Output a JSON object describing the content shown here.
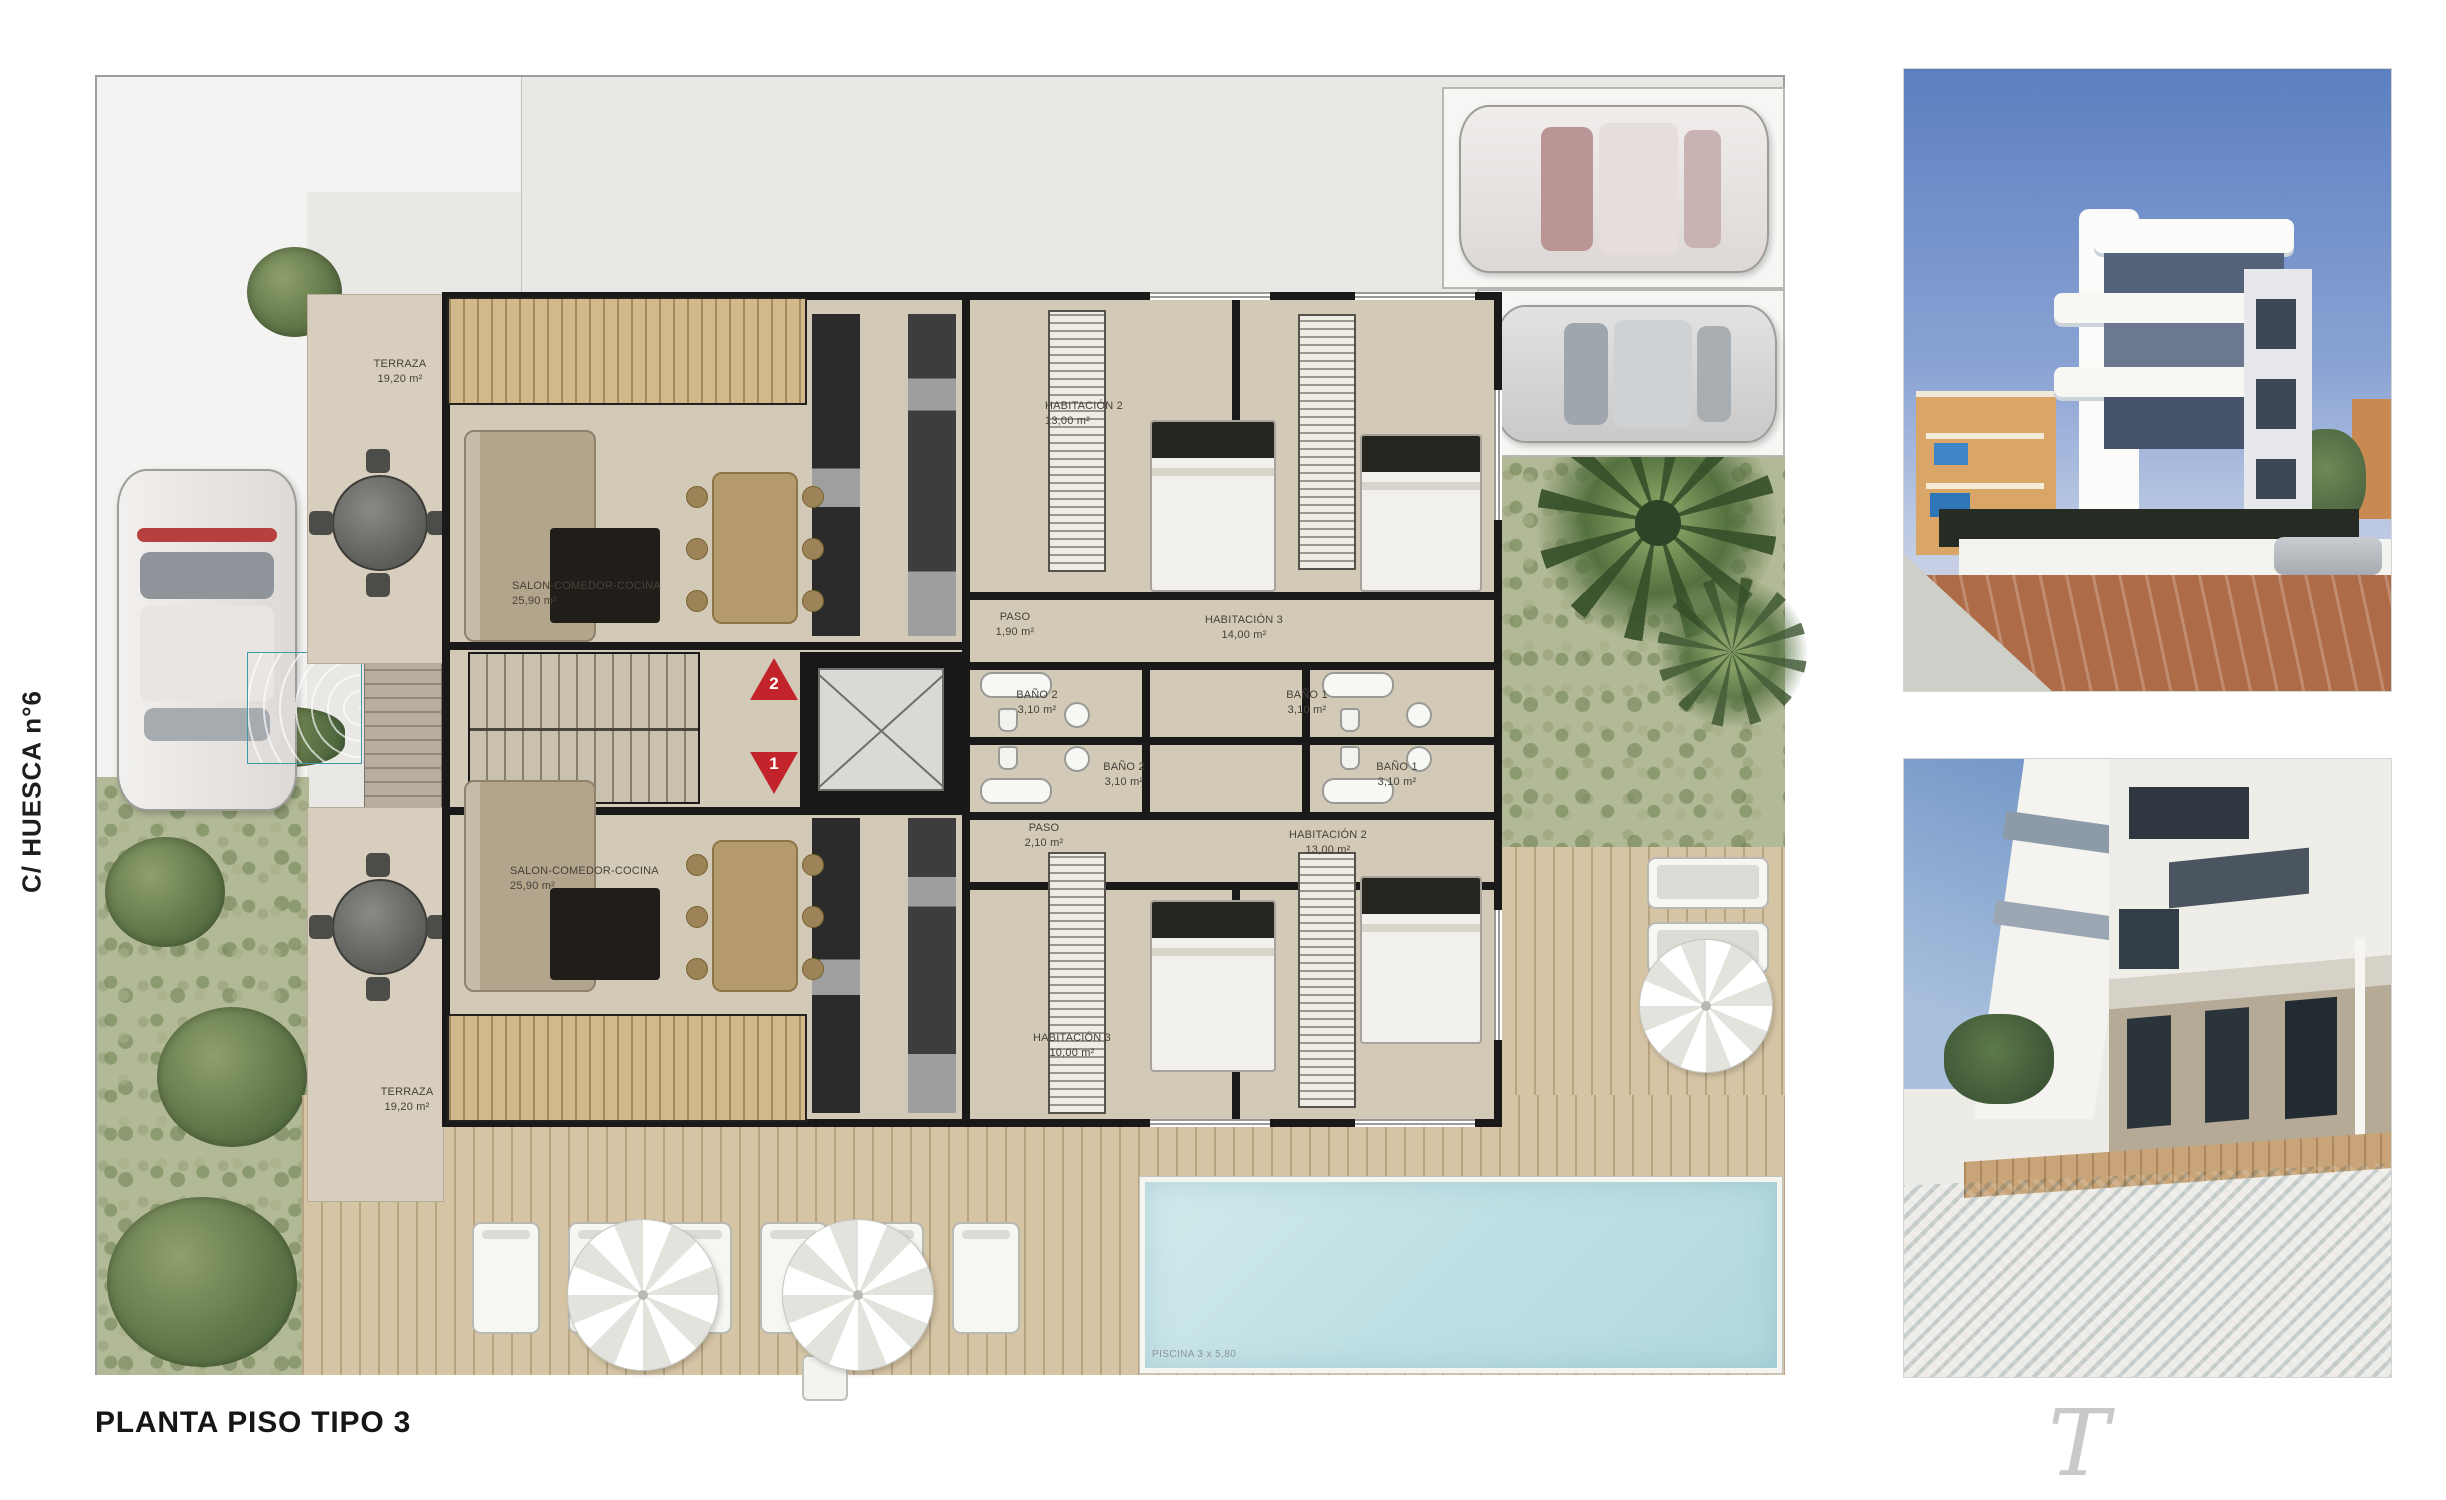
{
  "page": {
    "title": "PLANTA PISO TIPO 3",
    "street_label": "C/ HUESCA n°6",
    "signature": "T"
  },
  "plan": {
    "pool_label": "PISCINA 3 x 5,80",
    "markers": [
      {
        "number": "2"
      },
      {
        "number": "1"
      }
    ],
    "labels": [
      {
        "name": "TERRAZA",
        "area": "19,20 m²"
      },
      {
        "name": "SALON-COMEDOR-COCINA",
        "area": "25,90 m²"
      },
      {
        "name": "HABITACIÓN 2",
        "area": "13,00 m²"
      },
      {
        "name": "PASO",
        "area": "1,90 m²"
      },
      {
        "name": "HABITACIÓN 3",
        "area": "14,00 m²"
      },
      {
        "name": "BAÑO 2",
        "area": "3,10 m²"
      },
      {
        "name": "BAÑO 1",
        "area": "3,10 m²"
      },
      {
        "name": "SALON-COMEDOR-COCINA",
        "area": "25,90 m²"
      },
      {
        "name": "TERRAZA",
        "area": "19,20 m²"
      },
      {
        "name": "PASO",
        "area": "2,10 m²"
      },
      {
        "name": "HABITACIÓN 2",
        "area": "13,00 m²"
      },
      {
        "name": "BAÑO 2",
        "area": "3,10 m²"
      },
      {
        "name": "BAÑO 1",
        "area": "3,10 m²"
      },
      {
        "name": "HABITACIÓN 3",
        "area": "10,00 m²"
      }
    ],
    "colors": {
      "wall": "#191919",
      "floor": "#d3c9b7",
      "wood_deck": "#d2b98c",
      "grass": "#b2b996",
      "pool": "#bfe0e4",
      "marker_red": "#c3242b"
    }
  },
  "photos": [
    {
      "alt": "building exterior photo"
    },
    {
      "alt": "pool terrace photo"
    }
  ]
}
